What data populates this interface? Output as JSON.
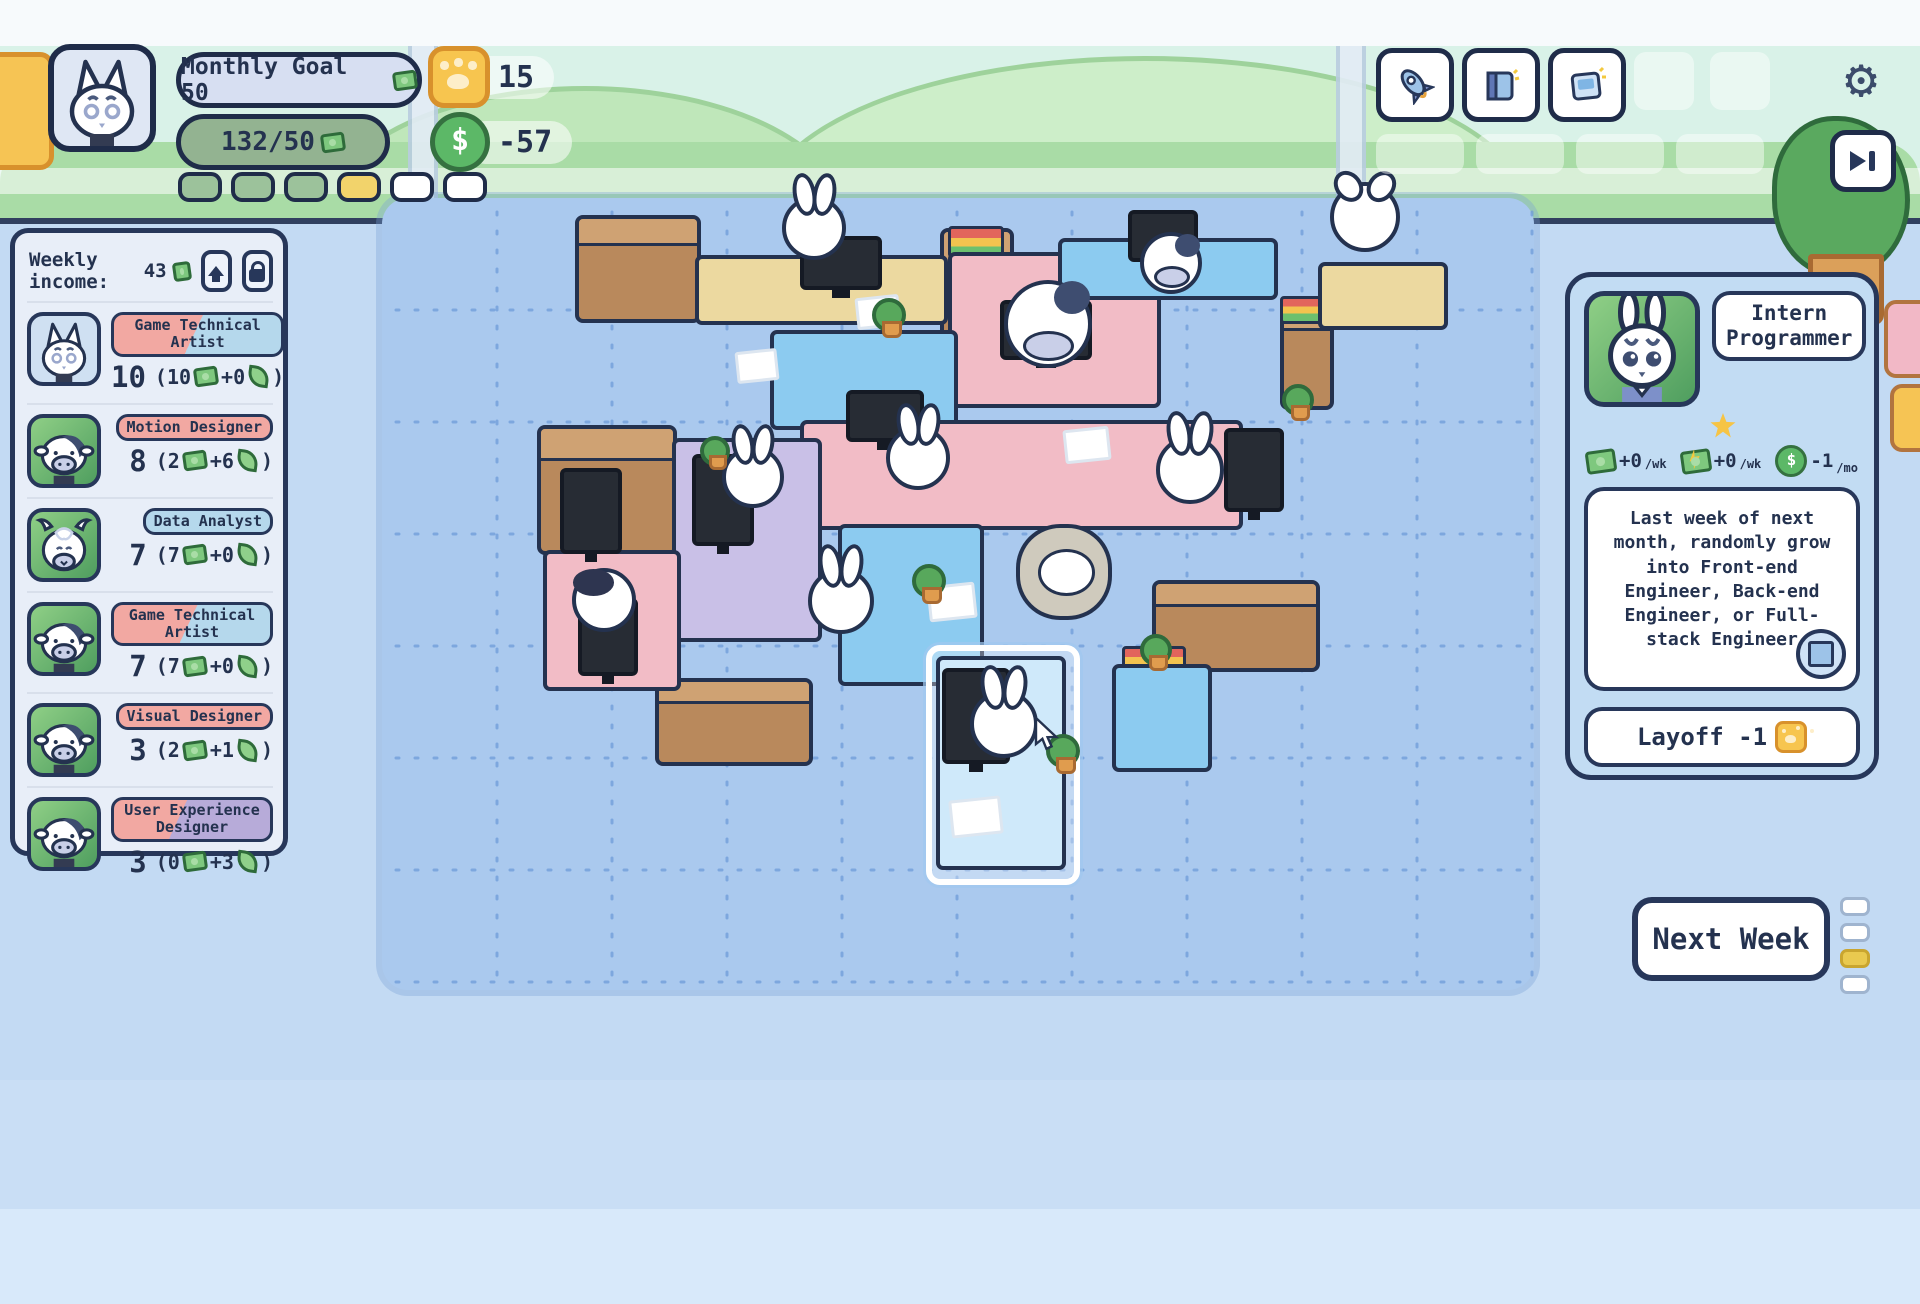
{
  "hud": {
    "avatar": "cat",
    "monthly_goal_label": "Monthly Goal 50",
    "progress_label": "132/50",
    "paw_balance": "15",
    "cash_flow": "-57",
    "goal_pips": [
      "filled",
      "filled",
      "filled",
      "active",
      "empty",
      "empty"
    ]
  },
  "topbar": {
    "action_buttons": [
      {
        "icon": "rocket-icon"
      },
      {
        "icon": "book-icon"
      },
      {
        "icon": "card-icon"
      }
    ],
    "ghost_slots": 2,
    "ghost_row_slots": 4,
    "settings_icon": "gear-icon",
    "skip_icon": "skip-icon"
  },
  "sidebar": {
    "weekly_income_label": "Weekly income:",
    "weekly_income_value": "43",
    "employees": [
      {
        "avatar": "cat",
        "avatar_bg": "av-blue",
        "role": "Game Technical Artist",
        "badge": "badge-split-pb",
        "value": "10",
        "cash": "10",
        "growth": "+0"
      },
      {
        "avatar": "cow",
        "avatar_bg": "av-green",
        "role": "Motion Designer",
        "badge": "badge-pink",
        "value": "8",
        "cash": "2",
        "growth": "+6"
      },
      {
        "avatar": "goat",
        "avatar_bg": "av-green",
        "role": "Data Analyst",
        "badge": "badge-blue",
        "value": "7",
        "cash": "7",
        "growth": "+0"
      },
      {
        "avatar": "cow",
        "avatar_bg": "av-green",
        "role": "Game Technical Artist",
        "badge": "badge-split-pb",
        "value": "7",
        "cash": "7",
        "growth": "+0"
      },
      {
        "avatar": "cow",
        "avatar_bg": "av-green",
        "role": "Visual Designer",
        "badge": "badge-pink",
        "value": "3",
        "cash": "2",
        "growth": "+1"
      },
      {
        "avatar": "cow",
        "avatar_bg": "av-green",
        "role": "User Experience Designer",
        "badge": "badge-split-pp",
        "value": "3",
        "cash": "0",
        "growth": "+3"
      }
    ]
  },
  "panel": {
    "avatar": "bunny",
    "role_title": "Intern Programmer",
    "stars": 1,
    "stats": [
      {
        "icon": "bill-icon",
        "value": "+0",
        "unit": "/wk"
      },
      {
        "icon": "bill-bolt-icon",
        "value": "+0",
        "unit": "/wk"
      },
      {
        "icon": "coin-icon",
        "value": "-1",
        "unit": "/mo"
      }
    ],
    "description": "Last week of next month, randomly grow into Front-end Engineer, Back-end Engineer, or Full-stack Engineer",
    "chip_icon": "chip-icon",
    "layoff_label": "Layoff -1"
  },
  "next_week": {
    "label": "Next Week",
    "pips": [
      "empty",
      "empty",
      "active",
      "empty"
    ]
  },
  "colors": {
    "outline_navy": "#24324f",
    "rug_blue": "#aac9ee",
    "pill_green": "#93b391",
    "pip_yellow": "#f2d36b",
    "paw_gold": "#f7c54f",
    "coin_green": "#5cb867"
  },
  "scene": {
    "items": [
      {
        "t": "cab",
        "x": 575,
        "y": 215,
        "w": 118,
        "h": 100
      },
      {
        "t": "cab",
        "x": 940,
        "y": 228,
        "w": 66,
        "h": 148
      },
      {
        "t": "cab",
        "x": 537,
        "y": 425,
        "w": 132,
        "h": 122
      },
      {
        "t": "cab",
        "x": 655,
        "y": 678,
        "w": 150,
        "h": 80
      },
      {
        "t": "cab",
        "x": 1152,
        "y": 580,
        "w": 160,
        "h": 84
      },
      {
        "t": "cab",
        "x": 1280,
        "y": 300,
        "w": 46,
        "h": 102
      },
      {
        "t": "stack",
        "x": 948,
        "y": 226,
        "w": 50,
        "h": 26
      },
      {
        "t": "stack",
        "x": 1280,
        "y": 296,
        "w": 44,
        "h": 22
      },
      {
        "t": "stack",
        "x": 1122,
        "y": 646,
        "w": 58,
        "h": 24
      },
      {
        "t": "desk",
        "x": 695,
        "y": 255,
        "w": 245,
        "h": 62,
        "c": "#ecd9a0"
      },
      {
        "t": "desk",
        "x": 1318,
        "y": 262,
        "w": 122,
        "h": 60,
        "c": "#ecd9a0"
      },
      {
        "t": "desk",
        "x": 948,
        "y": 252,
        "w": 205,
        "h": 148,
        "c": "#f2bcc6"
      },
      {
        "t": "desk",
        "x": 1058,
        "y": 238,
        "w": 212,
        "h": 54,
        "c": "#8ccbf0"
      },
      {
        "t": "desk",
        "x": 770,
        "y": 330,
        "w": 180,
        "h": 92,
        "c": "#8ccbf0"
      },
      {
        "t": "desk",
        "x": 800,
        "y": 420,
        "w": 435,
        "h": 102,
        "c": "#f2bcc6"
      },
      {
        "t": "desk",
        "x": 672,
        "y": 438,
        "w": 142,
        "h": 196,
        "c": "#c9c0e7"
      },
      {
        "t": "desk",
        "x": 543,
        "y": 550,
        "w": 130,
        "h": 133,
        "c": "#f2bcc6"
      },
      {
        "t": "desk",
        "x": 838,
        "y": 524,
        "w": 138,
        "h": 154,
        "c": "#8ccbf0"
      },
      {
        "t": "desk",
        "x": 1112,
        "y": 664,
        "w": 92,
        "h": 100,
        "c": "#8ccbf0"
      },
      {
        "t": "sel",
        "x": 926,
        "y": 645,
        "w": 142,
        "h": 228
      },
      {
        "t": "desk",
        "x": 936,
        "y": 656,
        "w": 122,
        "h": 206,
        "c": "#cfe9fa"
      },
      {
        "t": "mon",
        "x": 800,
        "y": 236,
        "w": 74,
        "h": 46
      },
      {
        "t": "mon",
        "x": 1128,
        "y": 210,
        "w": 62,
        "h": 44
      },
      {
        "t": "mon",
        "x": 1000,
        "y": 300,
        "w": 84,
        "h": 52
      },
      {
        "t": "mon",
        "x": 846,
        "y": 390,
        "w": 70,
        "h": 44
      },
      {
        "t": "mon",
        "x": 560,
        "y": 468,
        "w": 54,
        "h": 78
      },
      {
        "t": "mon",
        "x": 578,
        "y": 598,
        "w": 52,
        "h": 70
      },
      {
        "t": "mon",
        "x": 692,
        "y": 454,
        "w": 54,
        "h": 84
      },
      {
        "t": "mon",
        "x": 1224,
        "y": 428,
        "w": 52,
        "h": 76
      },
      {
        "t": "mon",
        "x": 942,
        "y": 668,
        "w": 60,
        "h": 88
      },
      {
        "t": "char",
        "v": "bunny",
        "x": 782,
        "y": 196,
        "s": 64
      },
      {
        "t": "char",
        "v": "goat",
        "x": 1330,
        "y": 182,
        "s": 70
      },
      {
        "t": "char",
        "v": "cow",
        "x": 1140,
        "y": 232,
        "s": 62
      },
      {
        "t": "char",
        "v": "cow",
        "x": 1004,
        "y": 280,
        "s": 88
      },
      {
        "t": "char",
        "v": "bunny",
        "x": 722,
        "y": 446,
        "s": 62
      },
      {
        "t": "char",
        "v": "bunny",
        "x": 886,
        "y": 426,
        "s": 64
      },
      {
        "t": "char",
        "v": "bunny",
        "x": 1156,
        "y": 436,
        "s": 68
      },
      {
        "t": "char",
        "v": "penguin",
        "x": 572,
        "y": 568,
        "s": 64
      },
      {
        "t": "char",
        "v": "bunny",
        "x": 808,
        "y": 568,
        "s": 66
      },
      {
        "t": "char",
        "v": "sheep",
        "x": 1016,
        "y": 524,
        "s": 96
      },
      {
        "t": "char",
        "v": "bunny",
        "x": 970,
        "y": 690,
        "s": 68
      },
      {
        "t": "paper",
        "x": 856,
        "y": 296,
        "w": 38,
        "h": 26
      },
      {
        "t": "paper",
        "x": 1064,
        "y": 428,
        "w": 40,
        "h": 28
      },
      {
        "t": "paper",
        "x": 928,
        "y": 584,
        "w": 42,
        "h": 30
      },
      {
        "t": "paper",
        "x": 950,
        "y": 798,
        "w": 46,
        "h": 32
      },
      {
        "t": "paper",
        "x": 736,
        "y": 350,
        "w": 36,
        "h": 26
      },
      {
        "t": "plant",
        "x": 872,
        "y": 298,
        "s": 26
      },
      {
        "t": "plant",
        "x": 1282,
        "y": 384,
        "s": 24
      },
      {
        "t": "plant",
        "x": 912,
        "y": 564,
        "s": 26
      },
      {
        "t": "plant",
        "x": 1046,
        "y": 734,
        "s": 26
      },
      {
        "t": "plant",
        "x": 700,
        "y": 436,
        "s": 22
      },
      {
        "t": "plant",
        "x": 1140,
        "y": 634,
        "s": 24
      }
    ]
  }
}
